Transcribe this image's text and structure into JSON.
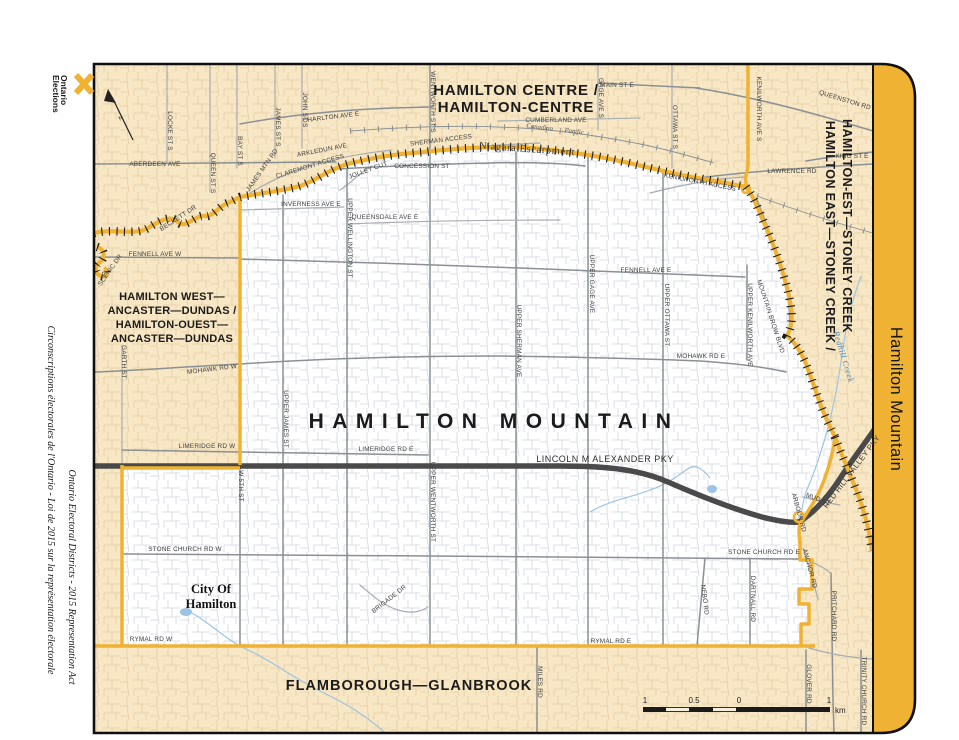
{
  "map_sheet": {
    "band_title": "Hamilton Mountain",
    "districts": {
      "centre": {
        "line1": "HAMILTON CENTRE /",
        "line2": "HAMILTON-CENTRE"
      },
      "east": {
        "line1": "HAMILTON EAST—STONEY CREEK /",
        "line2": "HAMILTON-EST—STONEY CREEK"
      },
      "west": {
        "line1": "HAMILTON WEST—",
        "line2": "ANCASTER—DUNDAS /",
        "line3": "HAMILTON-OUEST—",
        "line4": "ANCASTER—DUNDAS"
      },
      "mountain": {
        "name": "HAMILTON MOUNTAIN"
      },
      "flamborough": {
        "name": "FLAMBOROUGH—GLANBROOK"
      }
    },
    "city_label": {
      "line1": "City Of",
      "line2": "Hamilton"
    },
    "features": {
      "escarpment": "Niagara Escarpment",
      "railway": "Canadian Pacific",
      "creek": "Redhill Creek"
    },
    "streets": {
      "main_st_e": "MAIN ST E",
      "queenston_rd": "QUEENSTON RD",
      "king_st_e": "KING ST E",
      "lawrence_rd": "LAWRENCE RD",
      "kenilworth_ave_s": "KENILWORTH AVE S",
      "ottawa_st_s": "OTTAWA ST S",
      "gage_ave_s": "GAGE AVE S",
      "wentworth_st_s": "WENTWORTH ST S",
      "john_st_s": "JOHN ST S",
      "james_st_s": "JAMES ST S",
      "bay_st_s": "BAY ST S",
      "queen_st_s": "QUEEN ST S",
      "locke_st_s": "LOCKE ST S",
      "aberdeen_ave": "ABERDEEN AVE",
      "charlton_ave_e": "CHARLTON AVE E",
      "arkledun_ave": "ARKLEDUN AVE",
      "cumberland_ave": "CUMBERLAND AVE",
      "james_mtn_rd": "JAMES MTN RD",
      "claremont_access": "CLAREMONT ACCESS",
      "jolley_cut": "JOLLEY CUT",
      "sherman_access": "SHERMAN ACCESS",
      "kenilworth_access": "KENILWORTH ACCESS",
      "concession_st": "CONCESSION ST",
      "beckett_dr": "BECKETT DR",
      "scenic_dr": "SCENIC DR",
      "fennell_ave_w": "FENNELL AVE W",
      "fennell_ave_e": "FENNELL AVE E",
      "inverness_ave_e": "INVERNESS AVE E",
      "queensdale_ave_e": "QUEENSDALE AVE E",
      "upper_wellington_st": "UPPER WELLINGTON ST",
      "upper_james_st": "UPPER JAMES ST",
      "upper_wentworth_st": "UPPER WENTWORTH ST",
      "upper_sherman_ave": "UPPER SHERMAN AVE",
      "upper_gage_ave": "UPPER GAGE AVE",
      "upper_ottawa_st": "UPPER OTTAWA ST",
      "upper_kenilworth_ave": "UPPER KENILWORTH AVE",
      "mountain_brow_blvd": "MOUNTAIN BROW BLVD",
      "mohawk_rd_w": "MOHAWK RD W",
      "mohawk_rd_e": "MOHAWK RD E",
      "limeridge_rd_w": "LIMERIDGE RD W",
      "limeridge_rd_e": "LIMERIDGE RD E",
      "lincoln_alexander_pky": "LINCOLN M ALEXANDER PKY",
      "red_hill_valley_pky": "RED HILL VALLEY PKY",
      "garth_st": "GARTH ST",
      "w_5th_st": "W 5TH ST",
      "stone_church_rd_w": "STONE CHURCH RD W",
      "stone_church_rd_e": "STONE CHURCH RD E",
      "rymal_rd_w": "RYMAL RD W",
      "rymal_rd_e": "RYMAL RD E",
      "brigade_dr": "BRIGADE DR",
      "miles_rd": "MILES RD",
      "nebo_rd": "NEBO RD",
      "dartnall_rd": "DARTNALL RD",
      "anchor_rd": "ANCHOR RD",
      "arbour_rd": "ARBOUR RD",
      "mud_st": "MUD ST",
      "pritchard_rd": "PRITCHARD RD",
      "glover_rd": "GLOVER RD",
      "trinity_church_rd": "TRINITY CHURCH RD"
    },
    "north_label": "N",
    "scale_bar": {
      "tick_1_left": "1",
      "tick_05": "0.5",
      "tick_0": "0",
      "tick_1_right": "1",
      "unit": "km"
    }
  },
  "margin": {
    "logo": {
      "line1": "Elections",
      "line2": "Ontario"
    },
    "credit_en": "Ontario Electoral Districts - 2015 Representation Act",
    "credit_fr": "Circonscriptions électorales de l'Ontario - Loi de 2015 sur la représentation électorale"
  },
  "colors": {
    "boundary_gold": "#F0B232",
    "neighbour_beige": "#F8E7C4",
    "district_white": "#FFFFFF",
    "highway_dark": "#4A4A4A",
    "road_gray": "#8A9094",
    "creek_blue": "#9CC4E4",
    "label_black": "#1B1B1B"
  }
}
